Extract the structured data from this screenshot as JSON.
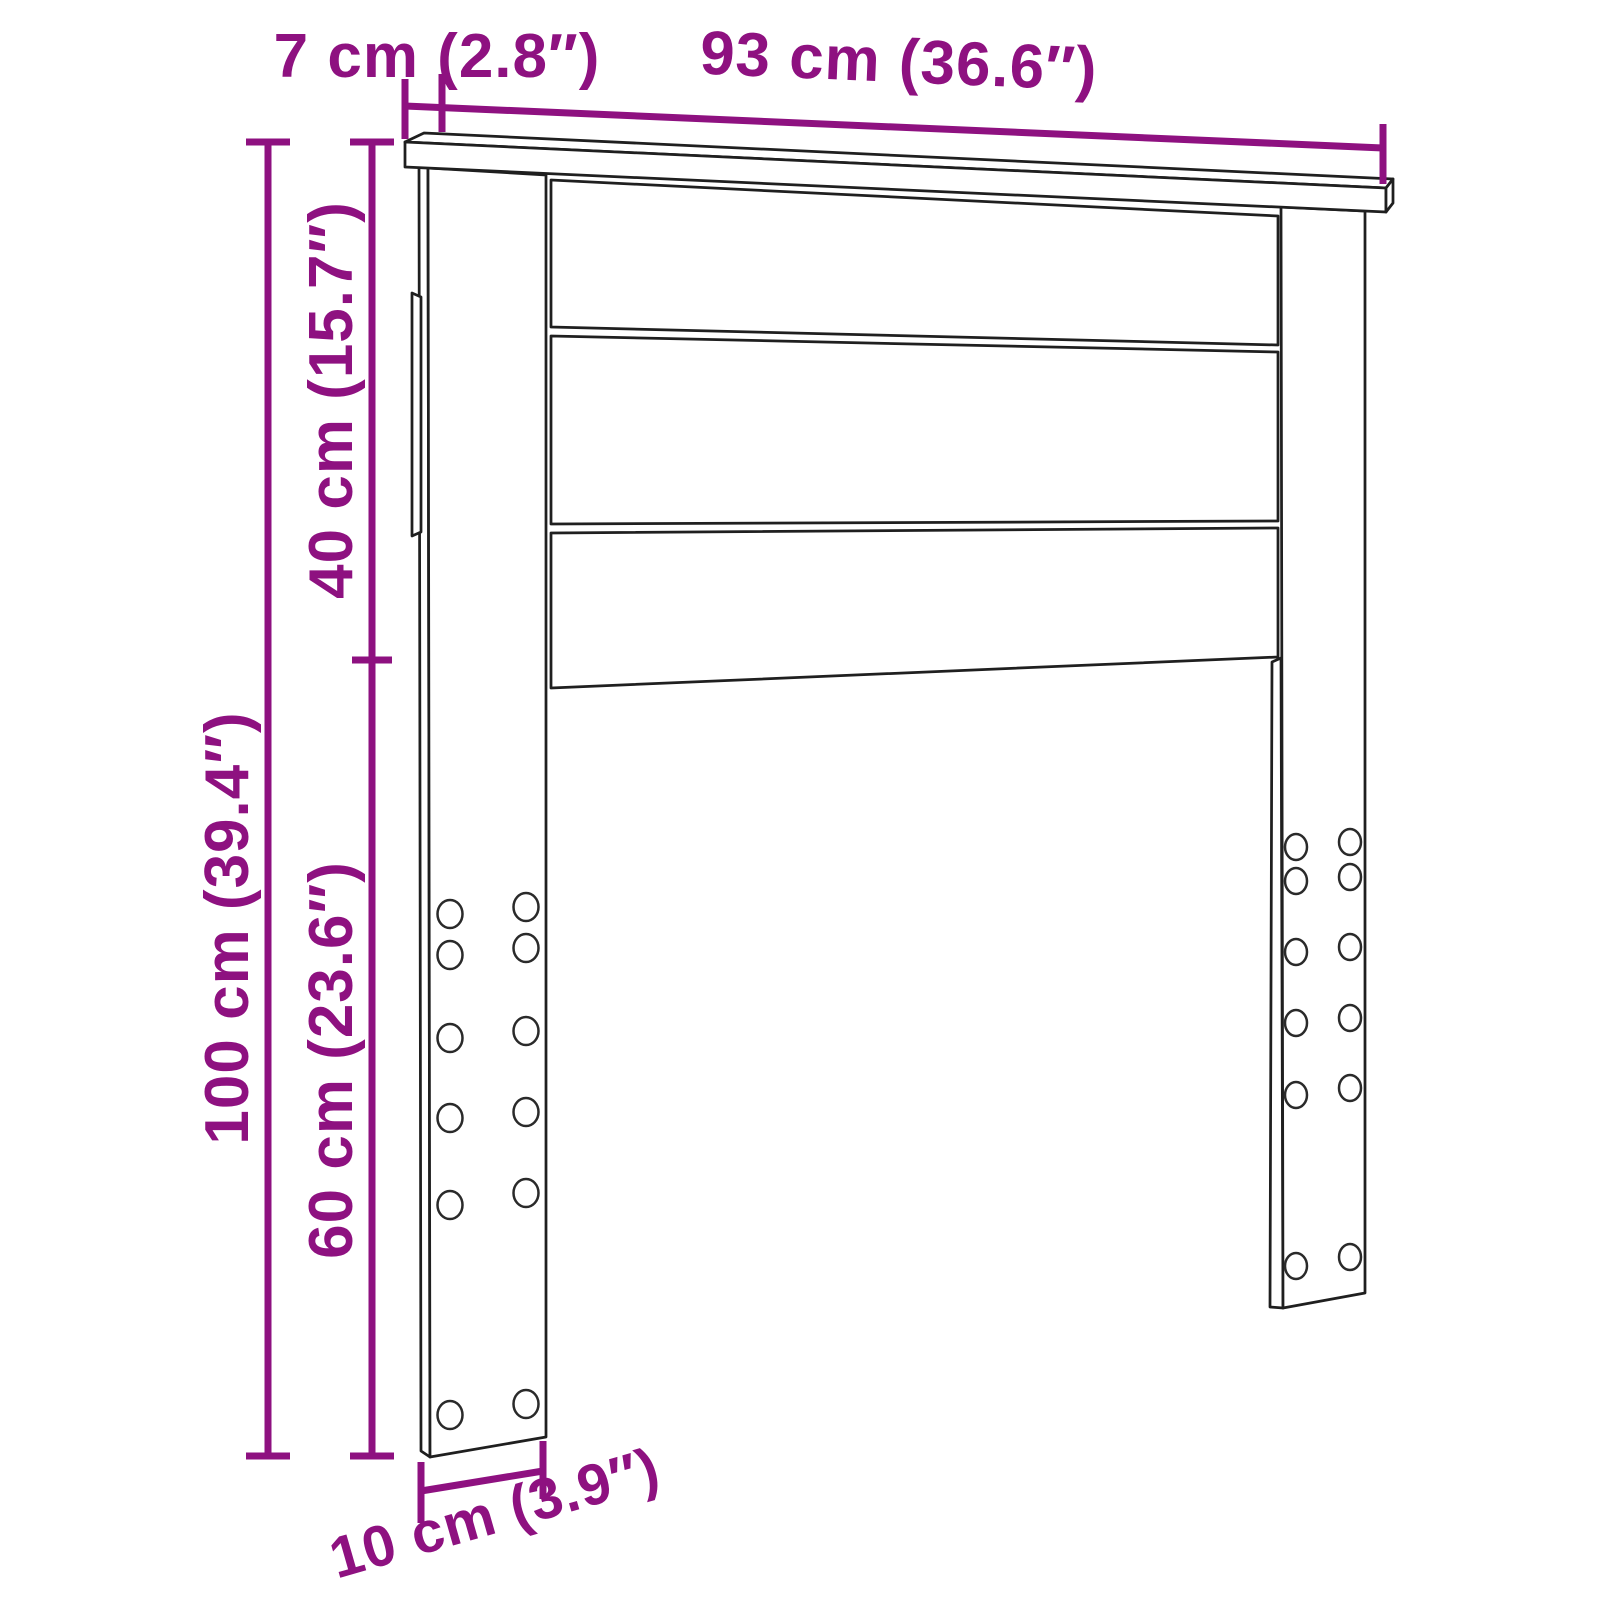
{
  "diagram": {
    "kind": "product-dimension-diagram",
    "subject": "headboard-line-drawing",
    "background": "#ffffff"
  },
  "colors": {
    "dimension_accent": "#8E1180",
    "line_art": "#1f1f1f"
  },
  "labels": {
    "top_depth": "7 cm (2.8″)",
    "top_width": "93 cm (36.6″)",
    "total_height": "100 cm (39.4″)",
    "panel_height": "40 cm (15.7″)",
    "leg_height": "60 cm (23.6″)",
    "leg_width": "10 cm (3.9″)"
  }
}
